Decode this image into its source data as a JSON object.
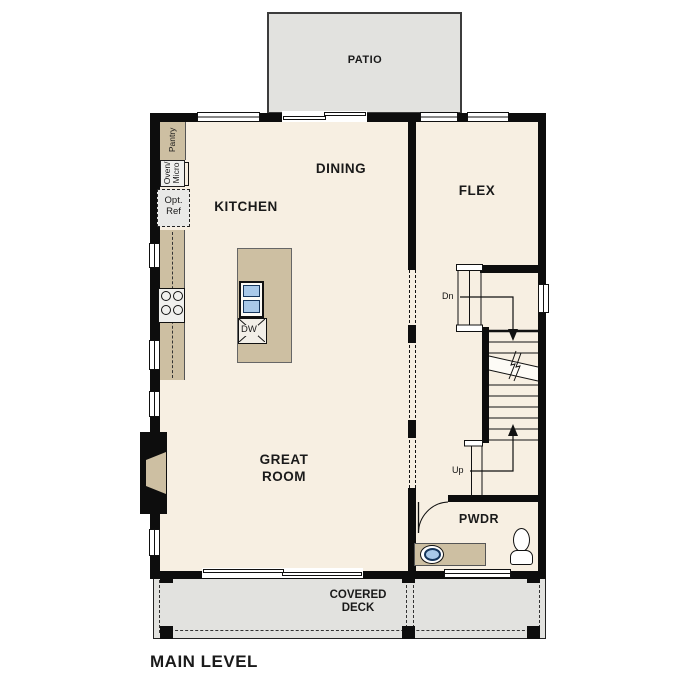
{
  "title": "MAIN LEVEL",
  "rooms": {
    "patio": "PATIO",
    "dining": "DINING",
    "kitchen": "KITCHEN",
    "flex": "FLEX",
    "great_room": "GREAT\nROOM",
    "pwdr": "PWDR",
    "covered_deck": "COVERED\nDECK"
  },
  "fixtures": {
    "pantry": "Pantry",
    "oven_micro": "Oven/\nMicro",
    "opt_ref": "Opt.\nRef",
    "dishwasher": "DW"
  },
  "stairs": {
    "down_label": "Dn",
    "up_label": "Up"
  },
  "colors": {
    "wall": "#0d0d0d",
    "floor": "#f7efe2",
    "counter_tan": "#cdbfa2",
    "area_gray": "#e2e2df",
    "sink_blue": "#a9c9e9",
    "sink_ring_navy": "#16365c"
  }
}
